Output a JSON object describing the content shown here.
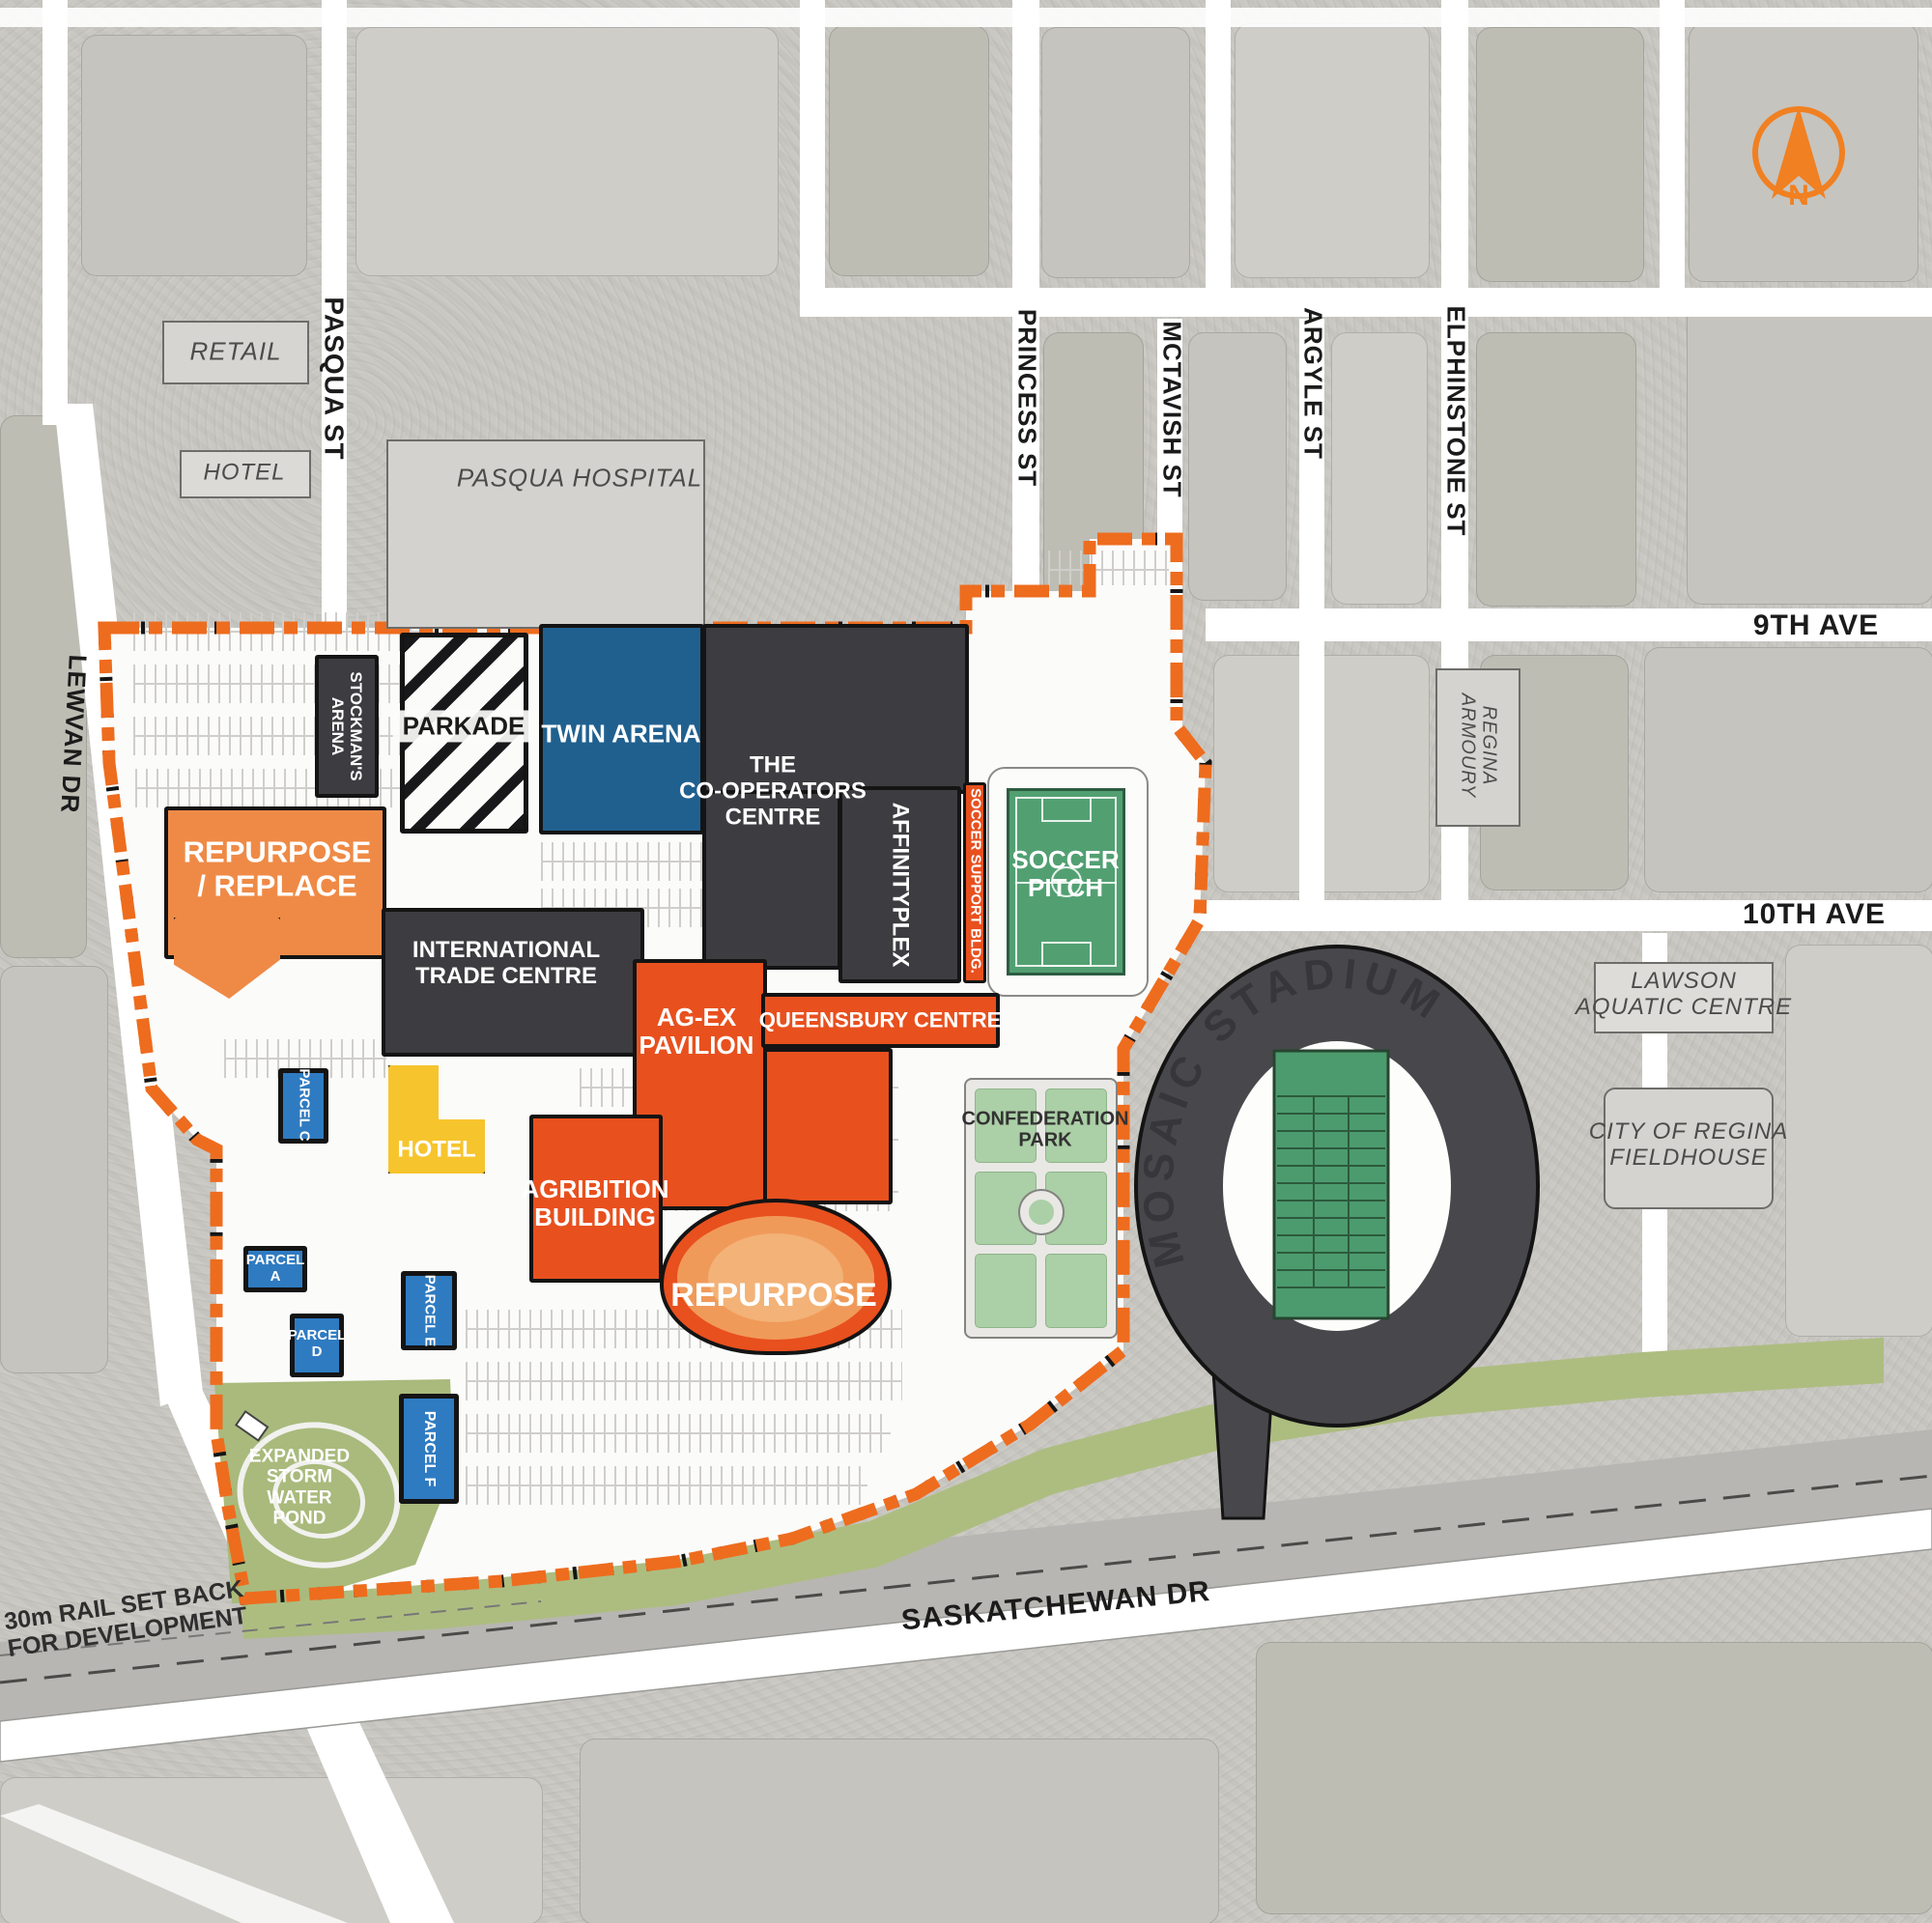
{
  "compass": {
    "label": "N"
  },
  "streets": {
    "pasqua": "PASQUA ST",
    "princess": "PRINCESS ST",
    "mctavish": "MCTAVISH ST",
    "argyle": "ARGYLE ST",
    "elphinstone": "ELPHINSTONE ST",
    "lewvan": "LEWVAN DR",
    "ninth_ave": "9TH AVE",
    "tenth_ave": "10TH AVE",
    "saskatchewan_dr": "SASKATCHEWAN DR"
  },
  "notes": {
    "rail_setback_line1": "30m RAIL SET BACK",
    "rail_setback_line2": "FOR DEVELOPMENT"
  },
  "context": {
    "retail": "RETAIL",
    "hotel": "HOTEL",
    "pasqua_hospital": "PASQUA HOSPITAL",
    "armoury_line1": "REGINA",
    "armoury_line2": "ARMOURY",
    "lawson_line1": "LAWSON",
    "lawson_line2": "AQUATIC CENTRE",
    "fieldhouse_line1": "CITY OF REGINA",
    "fieldhouse_line2": "FIELDHOUSE"
  },
  "site": {
    "stockmans_line1": "STOCKMAN'S",
    "stockmans_line2": "ARENA",
    "parkade": "PARKADE",
    "twin_arena": "TWIN ARENA",
    "cooperators_line1": "THE",
    "cooperators_line2": "CO-OPERATORS",
    "cooperators_line3": "CENTRE",
    "affinityplex": "AFFINITYPLEX",
    "soccer_support": "SOCCER SUPPORT BLDG.",
    "soccer_pitch_line1": "SOCCER",
    "soccer_pitch_line2": "PITCH",
    "repurpose_replace_line1": "REPURPOSE",
    "repurpose_replace_line2": "/ REPLACE",
    "itc_line1": "INTERNATIONAL",
    "itc_line2": "TRADE CENTRE",
    "agex_line1": "AG-EX",
    "agex_line2": "PAVILION",
    "queensbury": "QUEENSBURY CENTRE",
    "agribition_line1": "AGRIBITION",
    "agribition_line2": "BUILDING",
    "hotel": "HOTEL",
    "repurpose": "REPURPOSE",
    "confederation_line1": "CONFEDERATION",
    "confederation_line2": "PARK",
    "mosaic_stadium": "MOSAIC STADIUM",
    "parcel_c": "PARCEL C",
    "parcel_a_line1": "PARCEL",
    "parcel_a_line2": "A",
    "parcel_d_line1": "PARCEL",
    "parcel_d_line2": "D",
    "parcel_e": "PARCEL E",
    "parcel_f": "PARCEL F",
    "pond_line1": "EXPANDED",
    "pond_line2": "STORM",
    "pond_line3": "WATER",
    "pond_line4": "POND"
  },
  "colors": {
    "boundary_orange": "#ee6c1e",
    "repurpose_orange": "#ef8a46",
    "redevelop_orange": "#e8501e",
    "parcel_blue": "#2f7bc1",
    "arena_blue": "#20608f",
    "dark_building": "#3d3d41",
    "soccer_green": "#52a072",
    "park_green": "#abcfa6",
    "pond_olive": "#a9ba7c",
    "hotel_yellow": "#f6c42d",
    "context_gray": "#d4d3d0"
  }
}
